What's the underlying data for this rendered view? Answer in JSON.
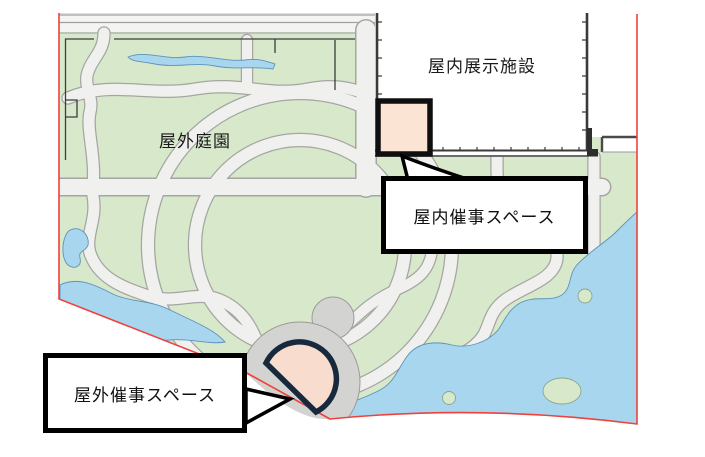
{
  "map": {
    "garden_label": "屋外庭園",
    "building_label": "屋内展示施設",
    "callouts": {
      "indoor_event": "屋内催事スペース",
      "outdoor_event": "屋外催事スペース"
    },
    "colors": {
      "green": "#d8e9cb",
      "water": "#a9d6ef",
      "water_edge": "#5d93b8",
      "path": "#f0f0ee",
      "path_edge": "#a5a5a3",
      "plaza": "#d3d3d1",
      "plaza_edge": "#9a9a98",
      "road_fill": "#f4f4f2",
      "highlight_fill": "#fce4d5",
      "fan_fill": "#f8dccd",
      "fan_outline": "#16293d",
      "boundary_red": "#f0423c",
      "wall": "#3a3a3a"
    }
  }
}
